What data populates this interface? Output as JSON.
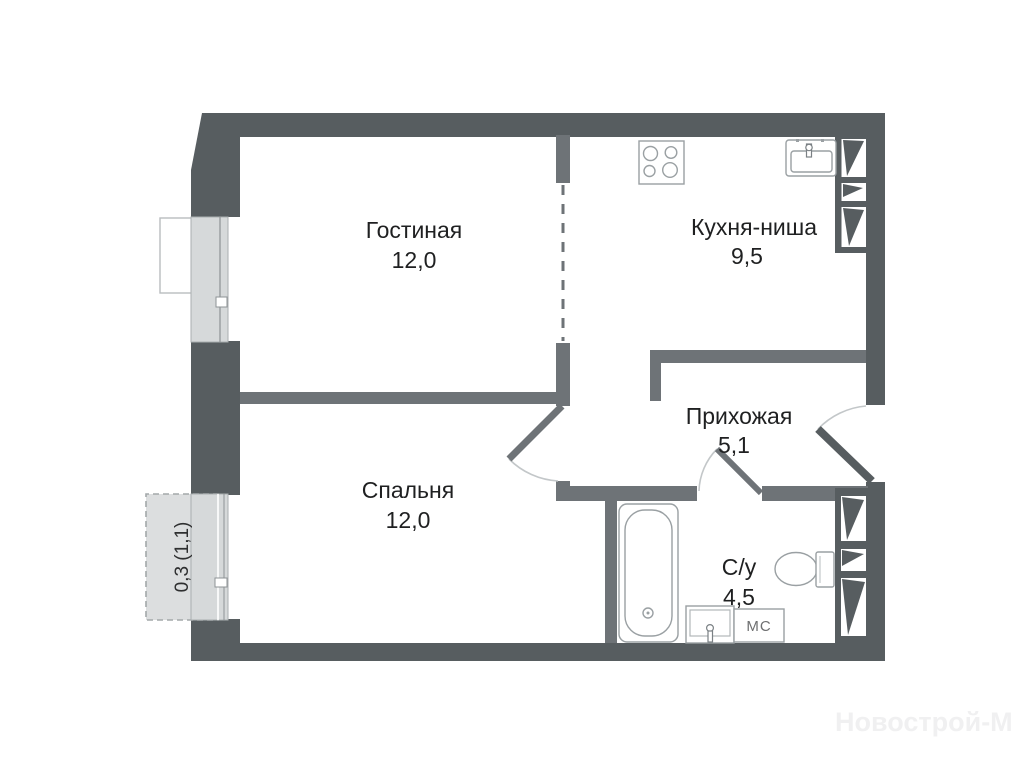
{
  "plan": {
    "title": "one-room apartment floor plan",
    "rooms": [
      {
        "id": "living",
        "name": "Гостиная",
        "area": "12,0"
      },
      {
        "id": "kitchen",
        "name": "Кухня-ниша",
        "area": "9,5"
      },
      {
        "id": "hallway",
        "name": "Прихожая",
        "area": "5,1"
      },
      {
        "id": "bedroom",
        "name": "Спальня",
        "area": "12,0"
      },
      {
        "id": "bathroom",
        "name": "С/у",
        "area": "4,5"
      }
    ],
    "balcony": {
      "label": "0,3 (1,1)"
    },
    "appliances": {
      "washing_machine_label": "МС"
    },
    "watermark": "Новострой-М"
  },
  "colors": {
    "wall_outer": "#575d60",
    "wall_inner": "#6e7377",
    "window_fill": "#d6d9da",
    "balcony_fill": "#dcdedf",
    "fixture_stroke": "#9aa0a3",
    "text": "#1f2021",
    "watermark": "#f0f0f1",
    "background": "#ffffff"
  }
}
